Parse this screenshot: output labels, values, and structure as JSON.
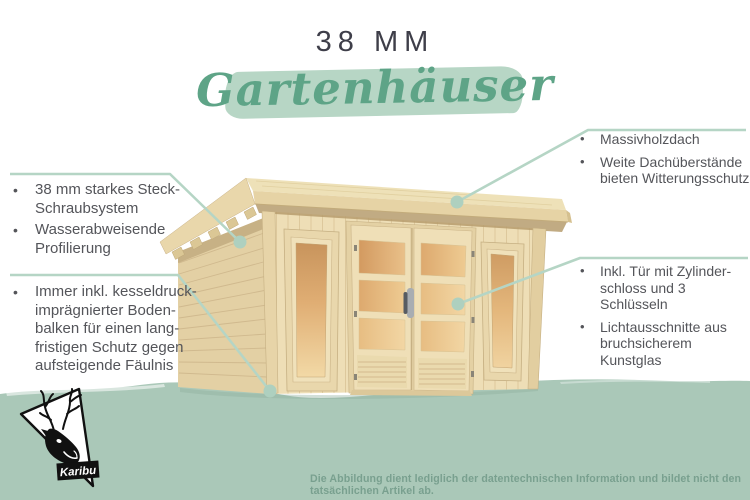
{
  "header": {
    "size_label": "38 MM",
    "category_title": "Gartenhäuser"
  },
  "callouts": {
    "bullet": "•",
    "left_top": {
      "items": [
        "38 mm starkes Steck-\nSchraubsystem",
        "Wasserabweisende\nProfilierung"
      ]
    },
    "left_bottom": {
      "items": [
        "Immer inkl. kesseldruck-\nimprägnierter Boden-\nbalken für einen lang-\nfristigen Schutz gegen\naufsteigende Fäulnis"
      ]
    },
    "right_top": {
      "items": [
        "Massivholzdach",
        "Weite Dachüberstände\nbieten Witterungsschutz"
      ]
    },
    "right_bottom": {
      "items": [
        "Inkl. Tür mit Zylinder-\nschloss und 3 Schlüsseln",
        "Lichtausschnitte aus\nbruchsicherem Kunstglas"
      ]
    }
  },
  "illustration": {
    "name": "wooden-garden-house-with-flat-roof-double-glass-door-and-two-windows"
  },
  "logo": {
    "brand": "Karibu",
    "icon": "caribou-head-in-triangle"
  },
  "footer": {
    "disclaimer": "Die Abbildung dient lediglich der datentechnischen Information und bildet nicht den tatsächlichen Artikel ab."
  },
  "colors": {
    "script_green": "#5ea487",
    "brush_green": "#b7d6c5",
    "wash_green": "#aac8b8",
    "callout_line": "#b5d5c5",
    "body_text": "#54555a",
    "title_text": "#3e3e49",
    "footer_text": "#79a08f",
    "wood_light": "#eedeb6",
    "glass_amber": "#d9a265"
  }
}
